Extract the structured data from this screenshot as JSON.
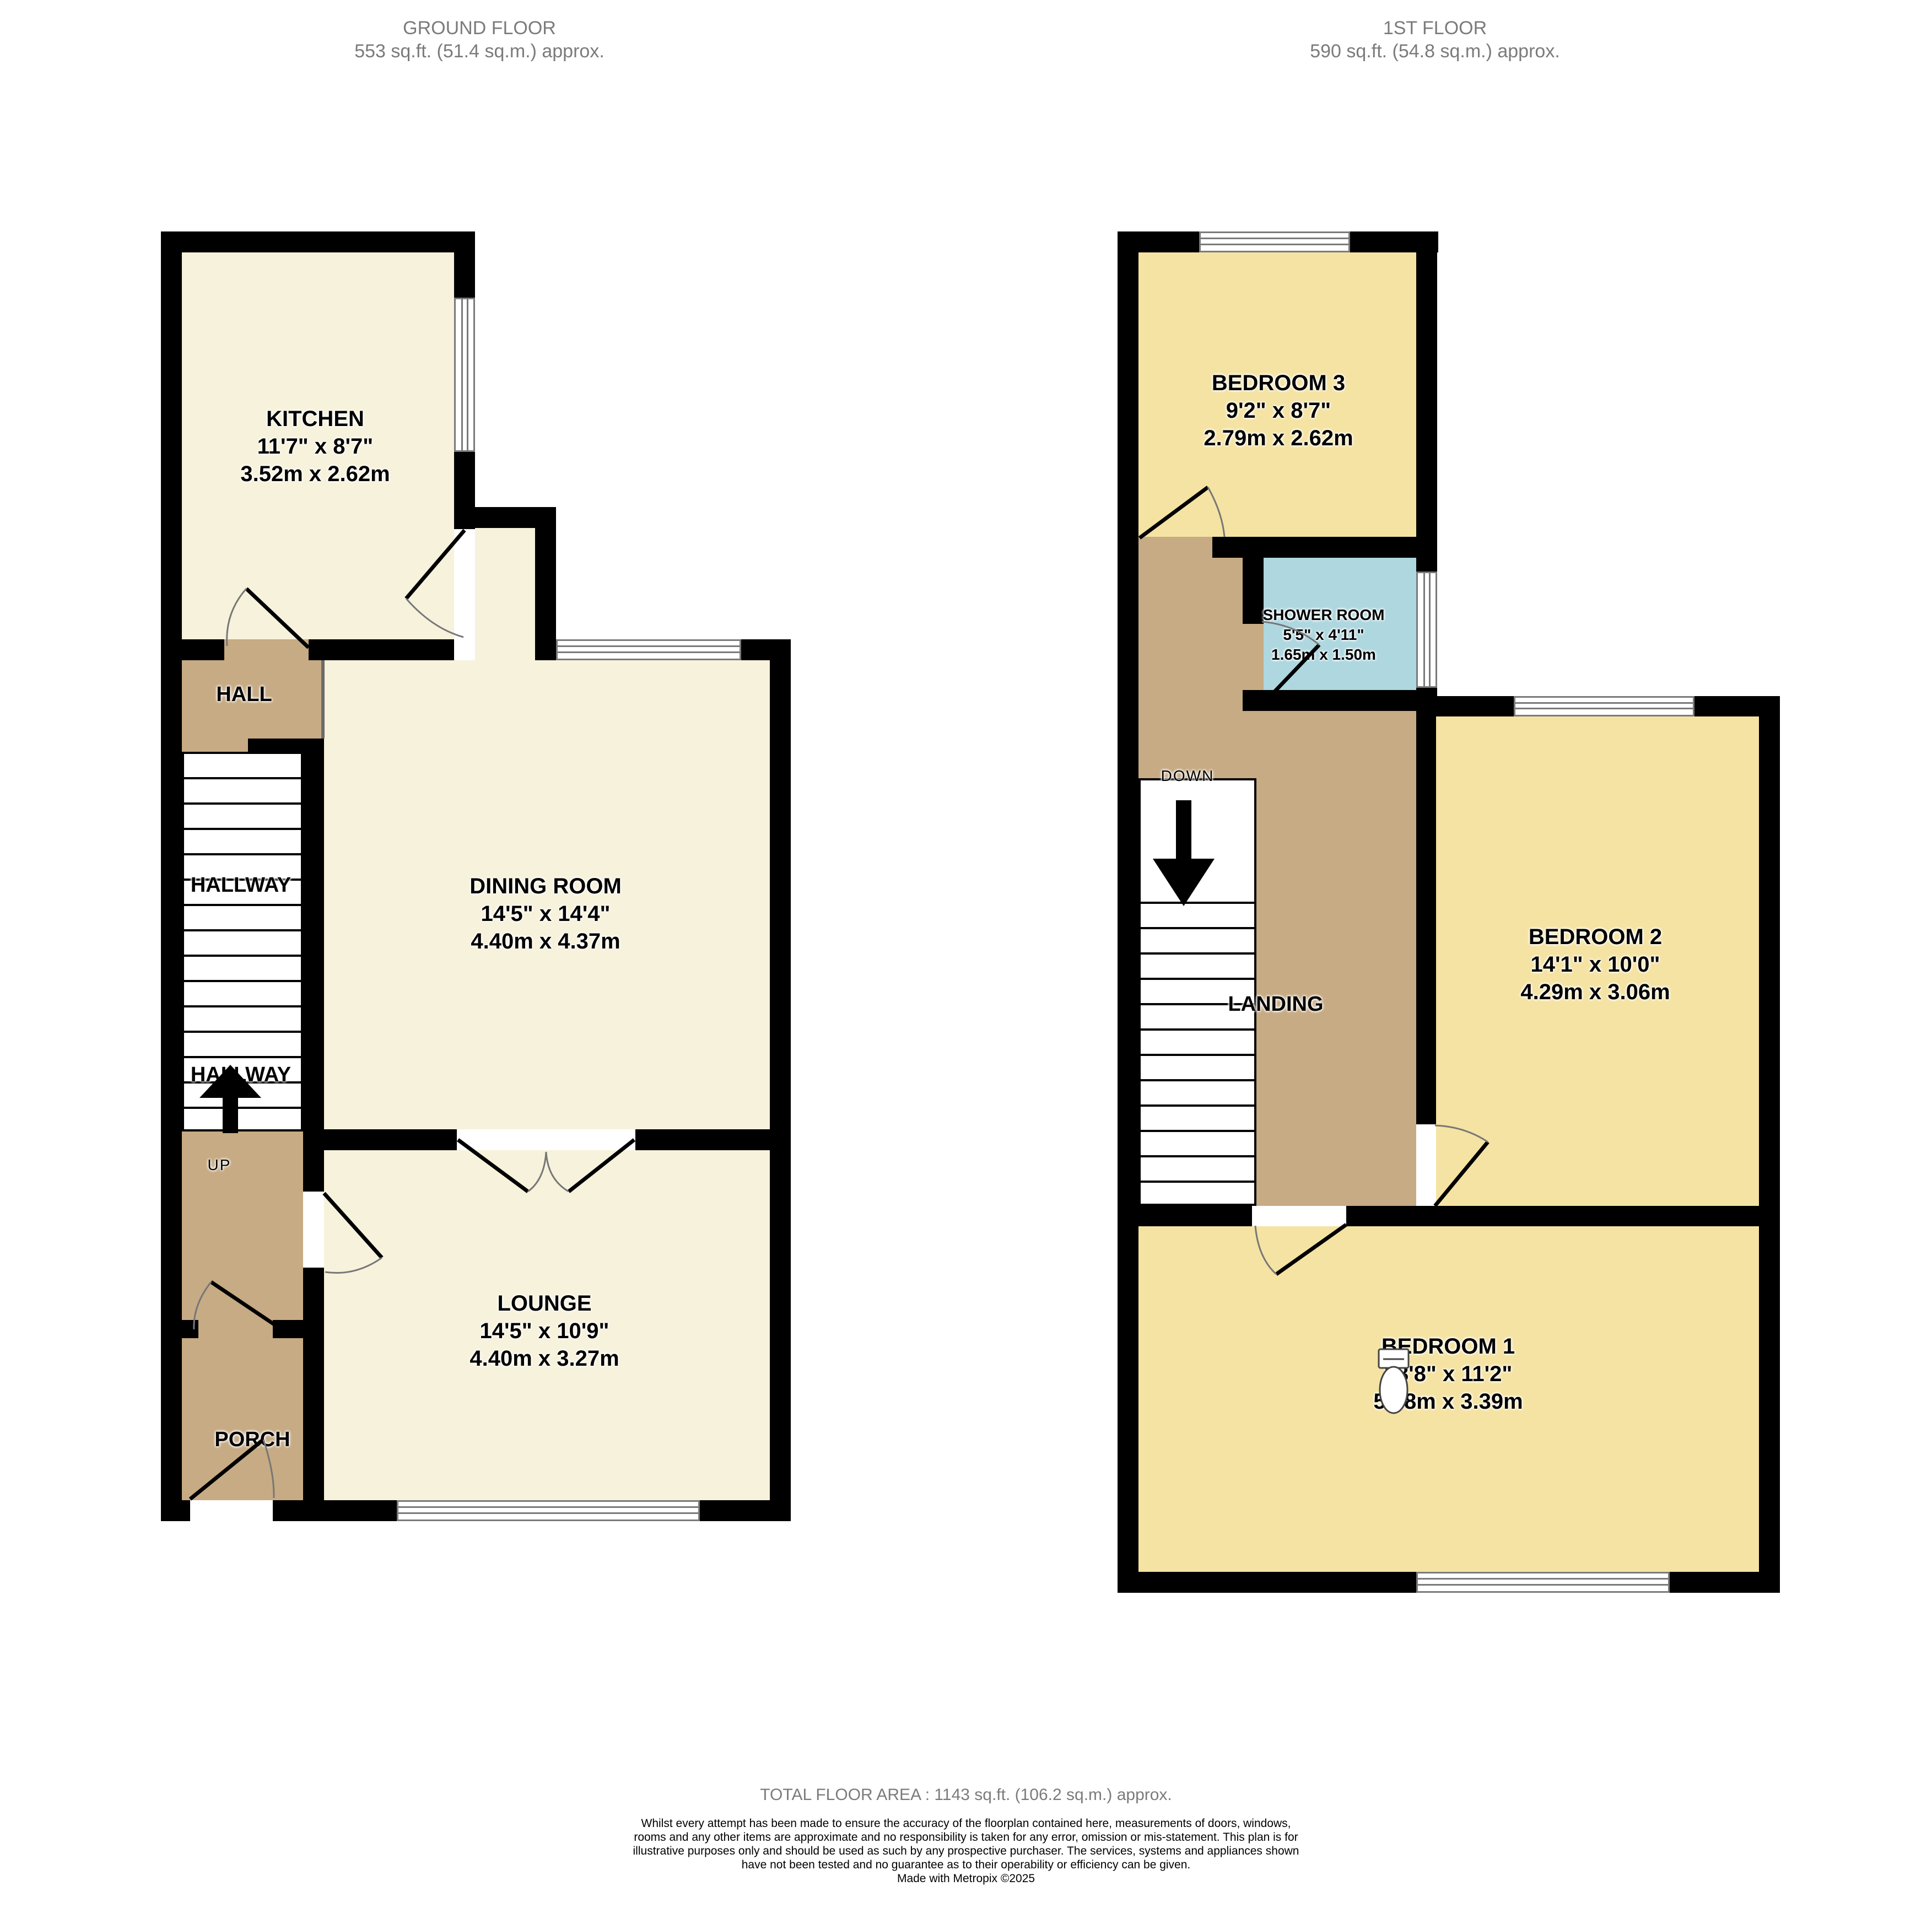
{
  "colors": {
    "cream": "#F7F2DB",
    "yellow": "#F5E3A3",
    "tan": "#C7AB84",
    "blue": "#AED7E0",
    "wall": "#000000",
    "muted_text": "#7B7B7B"
  },
  "headers": {
    "ground": {
      "title": "GROUND FLOOR",
      "area": "553 sq.ft. (51.4 sq.m.) approx."
    },
    "first": {
      "title": "1ST FLOOR",
      "area": "590 sq.ft. (54.8 sq.m.) approx."
    }
  },
  "ground": {
    "kitchen": {
      "name": "KITCHEN",
      "imperial": "11'7\"  x 8'7\"",
      "metric": "3.52m  x 2.62m"
    },
    "dining": {
      "name": "DINING ROOM",
      "imperial": "14'5\"  x 14'4\"",
      "metric": "4.40m  x 4.37m"
    },
    "lounge": {
      "name": "LOUNGE",
      "imperial": "14'5\"  x 10'9\"",
      "metric": "4.40m  x 3.27m"
    },
    "hall": "HALL",
    "hallway_upper": "HALLWAY",
    "hallway_lower": "HALLWAY",
    "up": "UP",
    "porch": "PORCH"
  },
  "first": {
    "bedroom3": {
      "name": "BEDROOM 3",
      "imperial": "9'2\"  x 8'7\"",
      "metric": "2.79m  x 2.62m"
    },
    "shower": {
      "name": "SHOWER ROOM",
      "imperial": "5'5\"  x 4'11\"",
      "metric": "1.65m  x 1.50m"
    },
    "bedroom2": {
      "name": "BEDROOM 2",
      "imperial": "14'1\"  x 10'0\"",
      "metric": "4.29m  x 3.06m"
    },
    "bedroom1": {
      "name": "BEDROOM 1",
      "imperial": "18'8\"  x 11'2\"",
      "metric": "5.68m  x 3.39m"
    },
    "down": "DOWN",
    "landing": "LANDING"
  },
  "footer": {
    "total": "TOTAL FLOOR AREA : 1143 sq.ft. (106.2 sq.m.) approx.",
    "disclaimer": "Whilst every attempt has been made to ensure the accuracy of the floorplan contained here, measurements of doors, windows, rooms and any other items are approximate and no responsibility is taken for any error, omission or mis-statement. This plan is for illustrative purposes only and should be used as such by any prospective purchaser. The services, systems and appliances shown have not been tested and no guarantee as to their operability or efficiency can be given.",
    "credit": "Made with Metropix ©2025"
  }
}
